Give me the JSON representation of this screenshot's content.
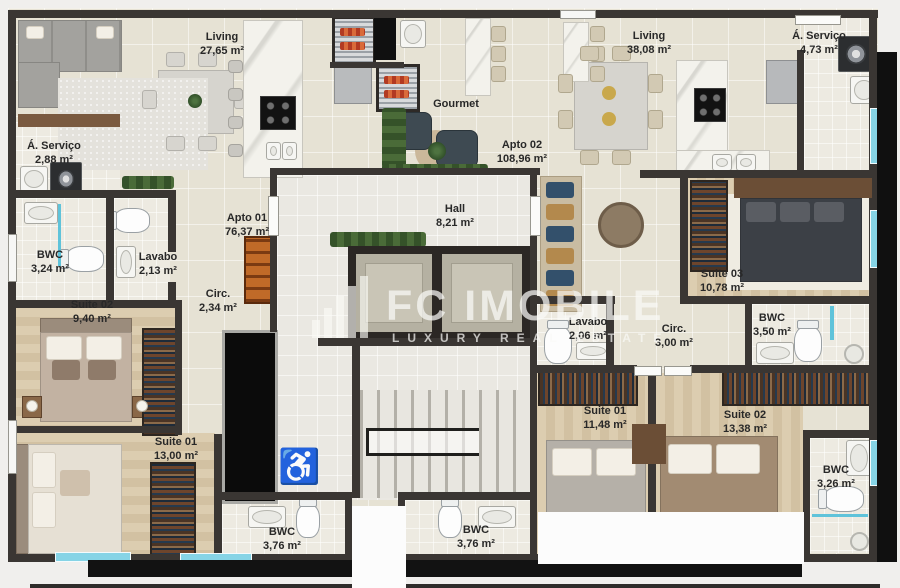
{
  "watermark": {
    "brand": "FC IMOBILE",
    "tagline": "LUXURY REAL ESTATE"
  },
  "icons": {
    "wheelchair": "♿"
  },
  "apartments": {
    "apto1": {
      "label": "Apto 01",
      "area": "76,37 m²"
    },
    "apto2": {
      "label": "Apto 02",
      "area": "108,96 m²"
    }
  },
  "rooms": {
    "a1_living": {
      "name": "Living",
      "area": "27,65 m²"
    },
    "a1_servico": {
      "name": "Á. Serviço",
      "area": "2,88 m²"
    },
    "a1_bwc": {
      "name": "BWC",
      "area": "3,24 m²"
    },
    "a1_lavabo": {
      "name": "Lavabo",
      "area": "2,13 m²"
    },
    "a1_circ": {
      "name": "Circ.",
      "area": "2,34 m²"
    },
    "a1_suite02": {
      "name": "Suite 02",
      "area": "9,40 m²"
    },
    "a1_suite01": {
      "name": "Suite 01",
      "area": "13,00 m²"
    },
    "a1_suite_bwc": {
      "name": "BWC",
      "area": "3,76 m²"
    },
    "a2_suite_bwc": {
      "name": "BWC",
      "area": "3,76 m²"
    },
    "gourmet": {
      "name": "Gourmet"
    },
    "hall": {
      "name": "Hall",
      "area": "8,21 m²"
    },
    "a2_living": {
      "name": "Living",
      "area": "38,08 m²"
    },
    "a2_servico": {
      "name": "Á. Serviço",
      "area": "4,73 m²"
    },
    "a2_suite03": {
      "name": "Suite 03",
      "area": "10,78 m²"
    },
    "a2_bwc_s03": {
      "name": "BWC",
      "area": "3,50 m²"
    },
    "a2_lavabo": {
      "name": "Lavabo",
      "area": "2,06 m²"
    },
    "a2_circ": {
      "name": "Circ.",
      "area": "3,00 m²"
    },
    "a2_suite01": {
      "name": "Suite 01",
      "area": "11,48 m²"
    },
    "a2_suite02": {
      "name": "Suite 02",
      "area": "13,38 m²"
    },
    "a2_bwc_s": {
      "name": "BWC",
      "area": "3,26 m²"
    }
  },
  "colors": {
    "wall": "#3a3633",
    "floor": "#e6e2d4",
    "wood": "#d8c8ab",
    "window": "#86d4e6",
    "cabinet_accent": "#b05a1e"
  }
}
